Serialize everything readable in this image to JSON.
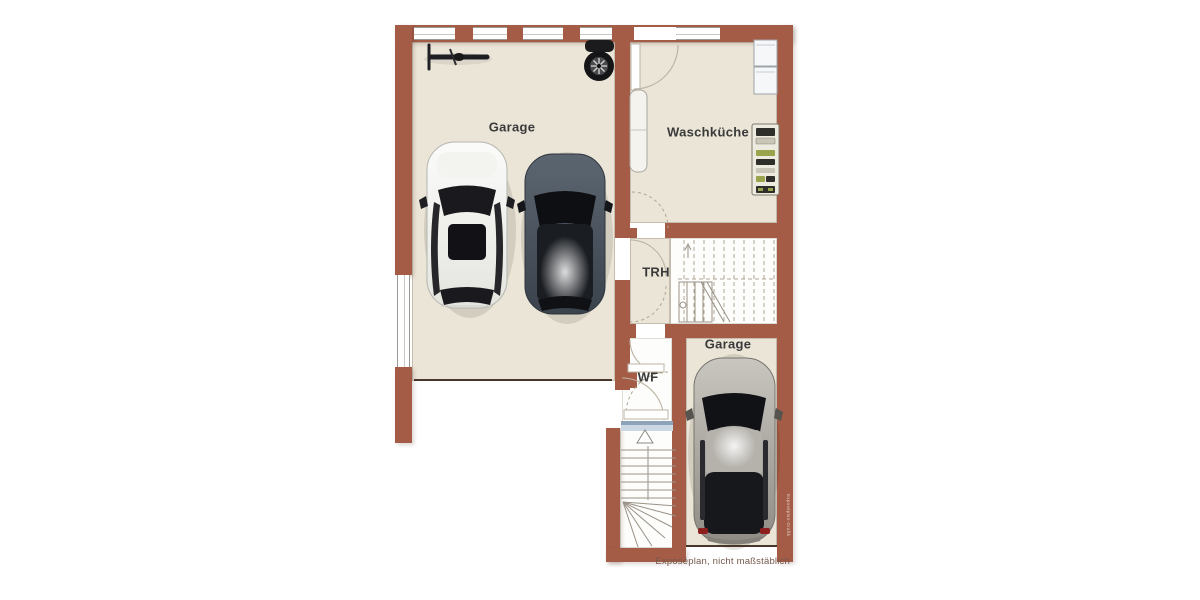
{
  "plan": {
    "type": "floor-plan-basement",
    "rooms": [
      {
        "id": "garage-left",
        "label": "Garage",
        "items": [
          "bicycle",
          "tire-stack",
          "white-car",
          "dark-gray-car"
        ]
      },
      {
        "id": "waschkueche",
        "label": "Waschküche",
        "items": [
          "washer-dryer-units",
          "storage-shelf",
          "water-heater"
        ]
      },
      {
        "id": "trh",
        "label": "TRH",
        "items": [
          "staircase-upper-flight"
        ]
      },
      {
        "id": "wf",
        "label": "WF",
        "items": [
          "entry-door",
          "direction-arrow"
        ]
      },
      {
        "id": "garage-lower",
        "label": "Garage",
        "items": [
          "silver-car"
        ]
      },
      {
        "id": "stairwell",
        "label": "",
        "items": [
          "staircase-entry-winder"
        ]
      }
    ]
  },
  "footer": {
    "caption": "Exposéplan, nicht maßstäblich"
  },
  "watermark": {
    "text": "Exposéplan-Grafik"
  },
  "objects": {
    "bicycle": "bicycle-top-view-icon",
    "tire_stack": "tire-stack-icon",
    "white_car": "car-top-view-white",
    "dark_car": "car-top-view-darkgray",
    "silver_car": "car-top-view-silver",
    "washer_dryer": "washer-dryer-top-view",
    "shelf": "storage-shelf-top-view",
    "boiler": "water-heater-top-view",
    "arrow": "entrance-direction-arrow"
  },
  "colors": {
    "wall": "#A45C47",
    "wall_edge": "#8A4937",
    "floor": "#EBE5D8",
    "floor_white": "#FDFDFB",
    "outline": "#BDB4A4",
    "stair_line": "#9A9287",
    "dashed_line": "#AFA693",
    "label_text": "#3A3A3A",
    "caption_text": "#75584B",
    "garage_door": "#4A372B",
    "threshold": "#8FA3B8",
    "threshold_light": "#CBD8E4",
    "shelf_green": "#9AA44C",
    "item_dark": "#2E2E2A",
    "watermark_text": "#E9DACF"
  }
}
